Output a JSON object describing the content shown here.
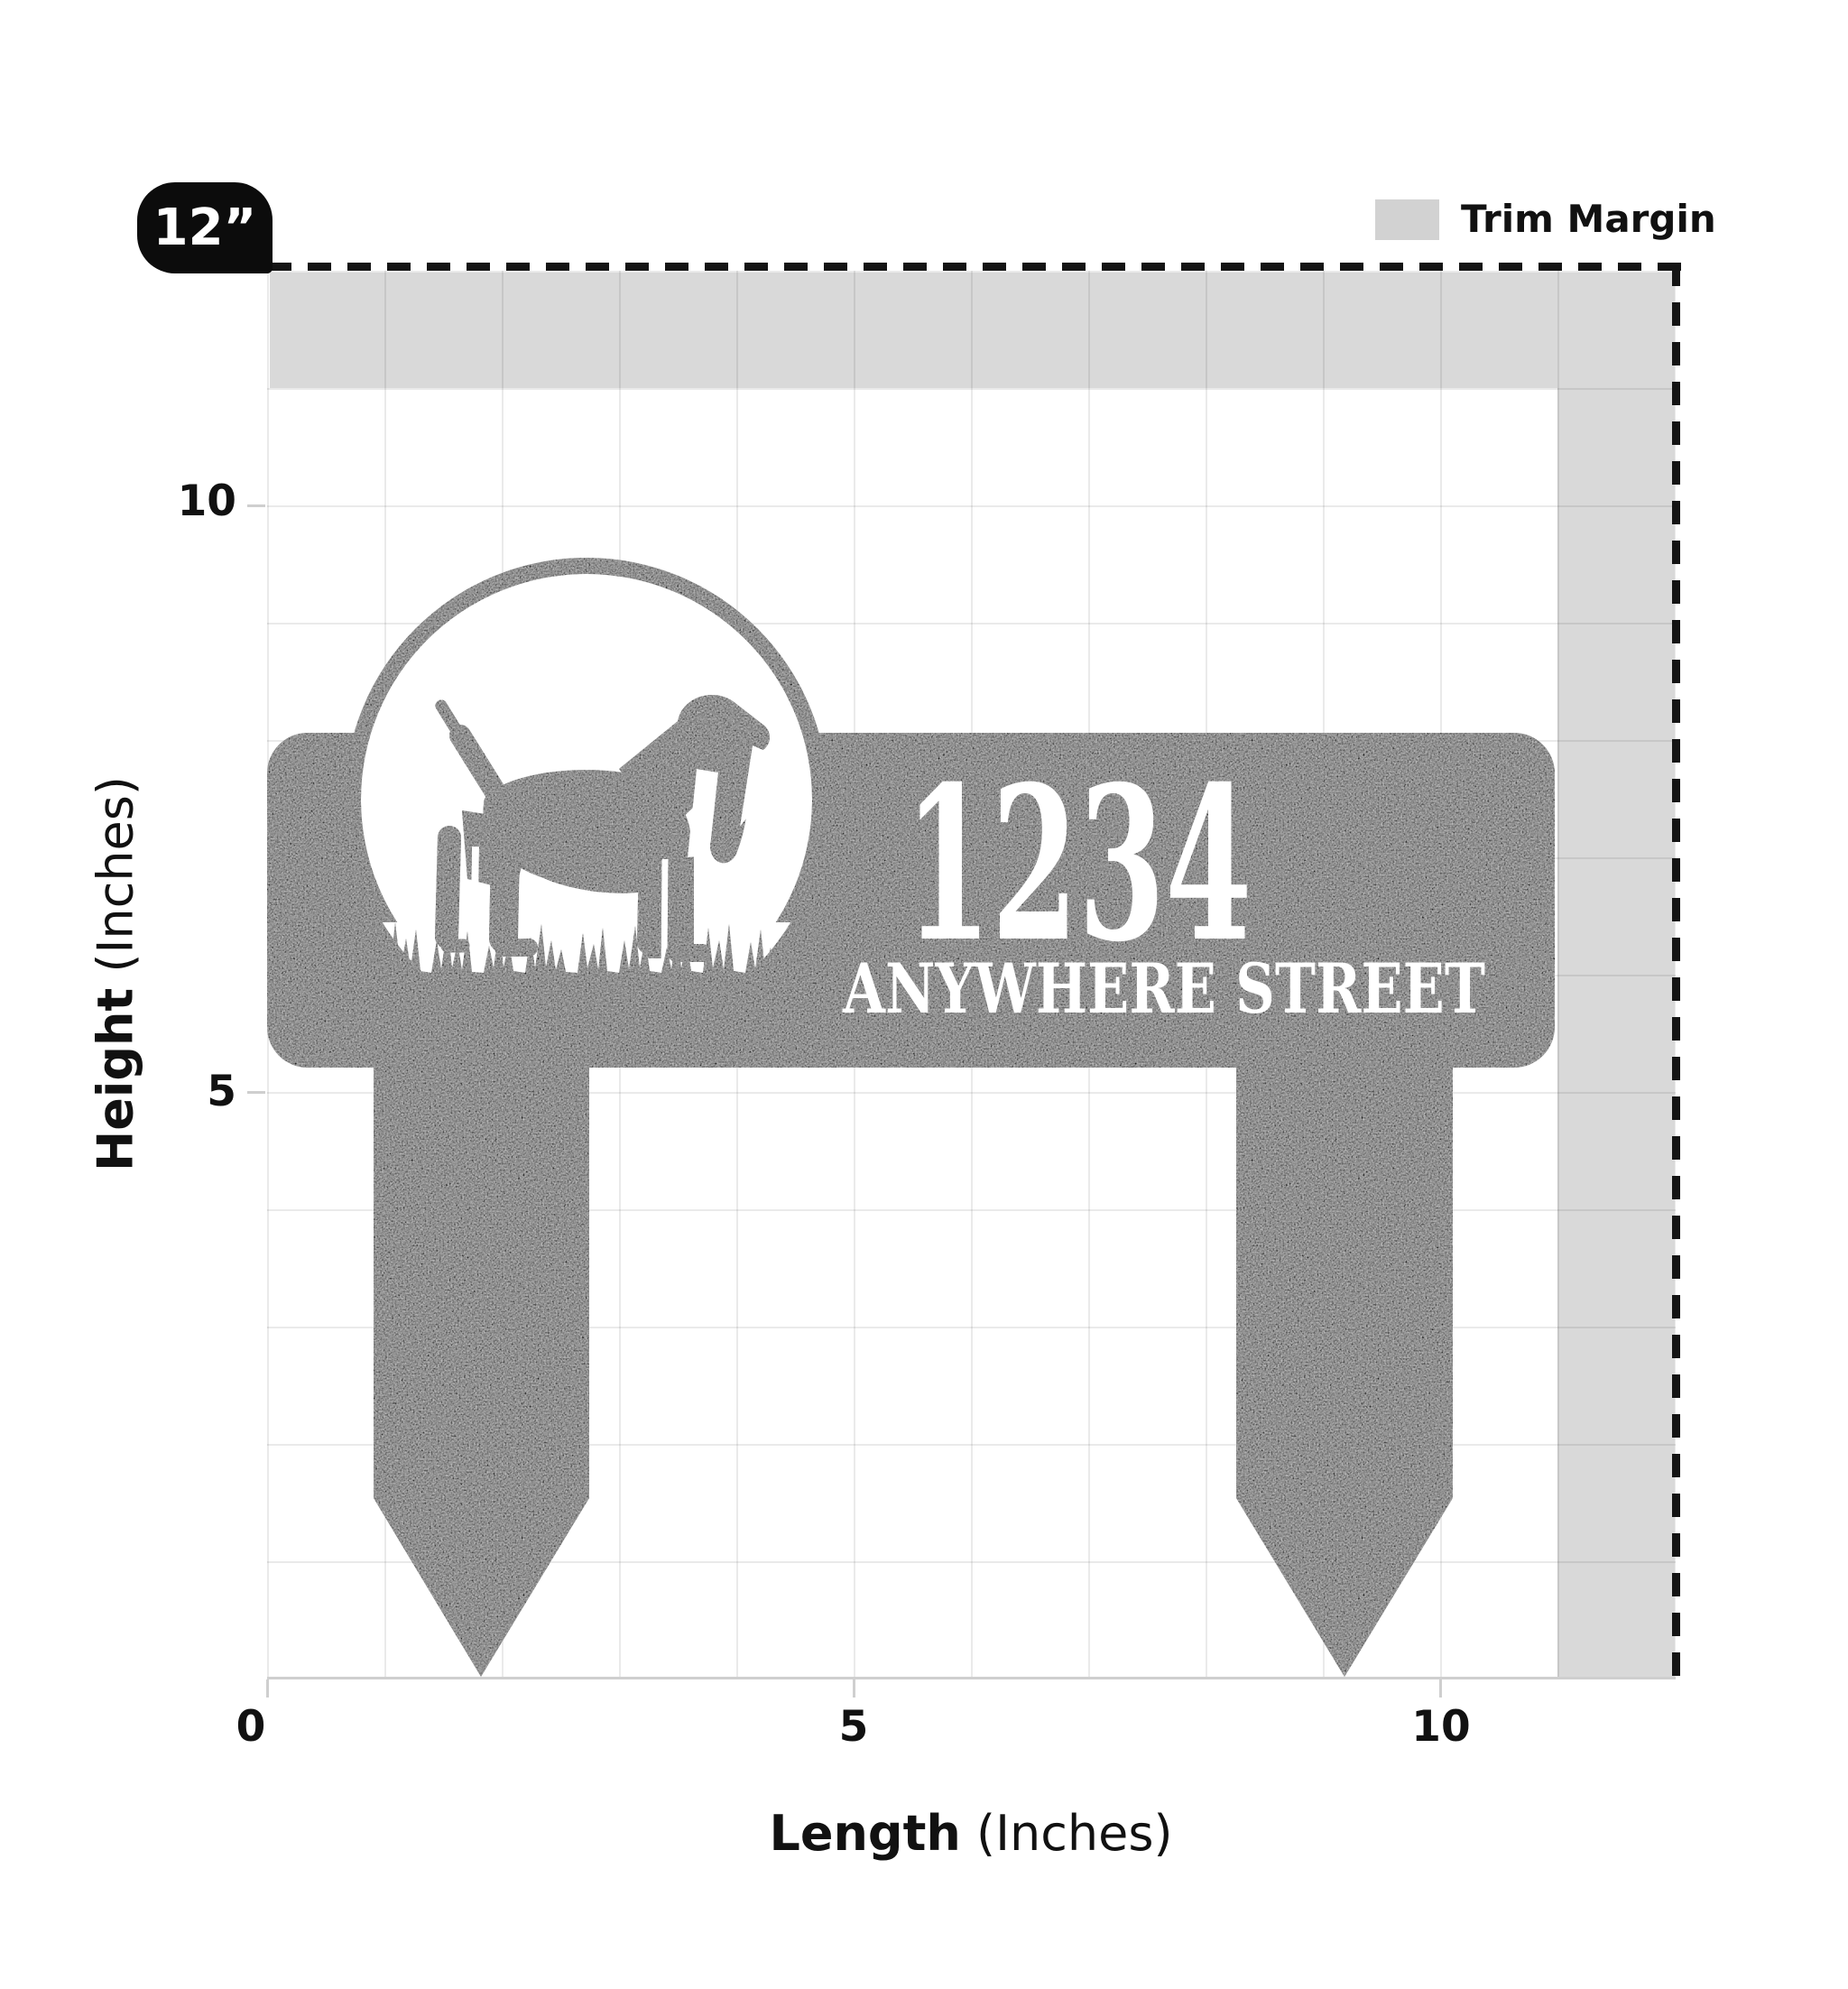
{
  "badge": {
    "label": "12”"
  },
  "legend": {
    "label": "Trim Margin",
    "swatch_color": "#d2d2d2"
  },
  "axes": {
    "x": {
      "title": "Length",
      "unit": "(Inches)",
      "ticks": [
        "0",
        "5",
        "10"
      ]
    },
    "y": {
      "title": "Height",
      "unit": "(Inches)",
      "ticks": [
        "10",
        "5"
      ]
    }
  },
  "sign": {
    "address_number": "1234",
    "street_name": "ANYWHERE STREET",
    "color": "#0f0f0f",
    "motif": "beagle-dog-in-circle-with-grass"
  },
  "colors": {
    "trim_margin_gray": "#d9d9d9",
    "dash_black": "#141414",
    "text_black": "#111111"
  }
}
